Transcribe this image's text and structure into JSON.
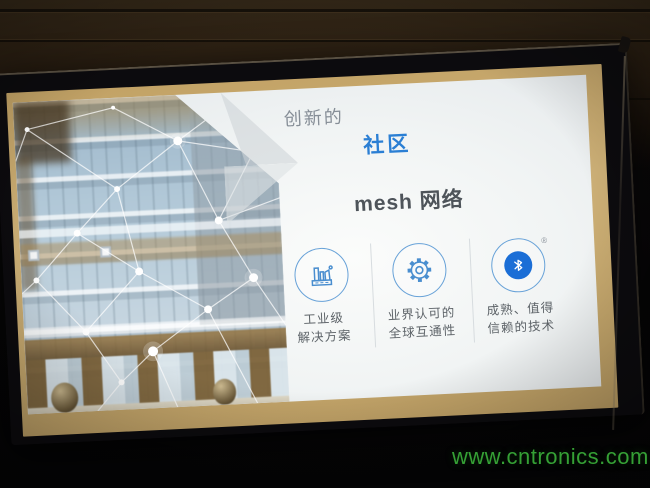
{
  "slide": {
    "title": {
      "prefix": "创新的",
      "highlight": "社区",
      "line2": "mesh 网络"
    },
    "features": [
      {
        "icon": "factory-icon",
        "label_line1": "工业级",
        "label_line2": "解决方案"
      },
      {
        "icon": "gear-icon",
        "label_line1": "业界认可的",
        "label_line2": "全球互通性"
      },
      {
        "icon": "bluetooth-icon",
        "registered_mark": "®",
        "label_line1": "成熟、值得",
        "label_line2": "信赖的技术"
      }
    ],
    "colors": {
      "accent_blue": "#2b7fd4",
      "icon_outline_blue": "#68a2d8",
      "bluetooth_blue": "#1b6ed6",
      "title_dark": "#4e545a",
      "title_gray": "#868e97",
      "label_gray": "#5d6368",
      "screen_border_beige": "#c9ac72"
    }
  },
  "watermark": {
    "text": "www.cntronics.com",
    "color": "#35a035"
  }
}
